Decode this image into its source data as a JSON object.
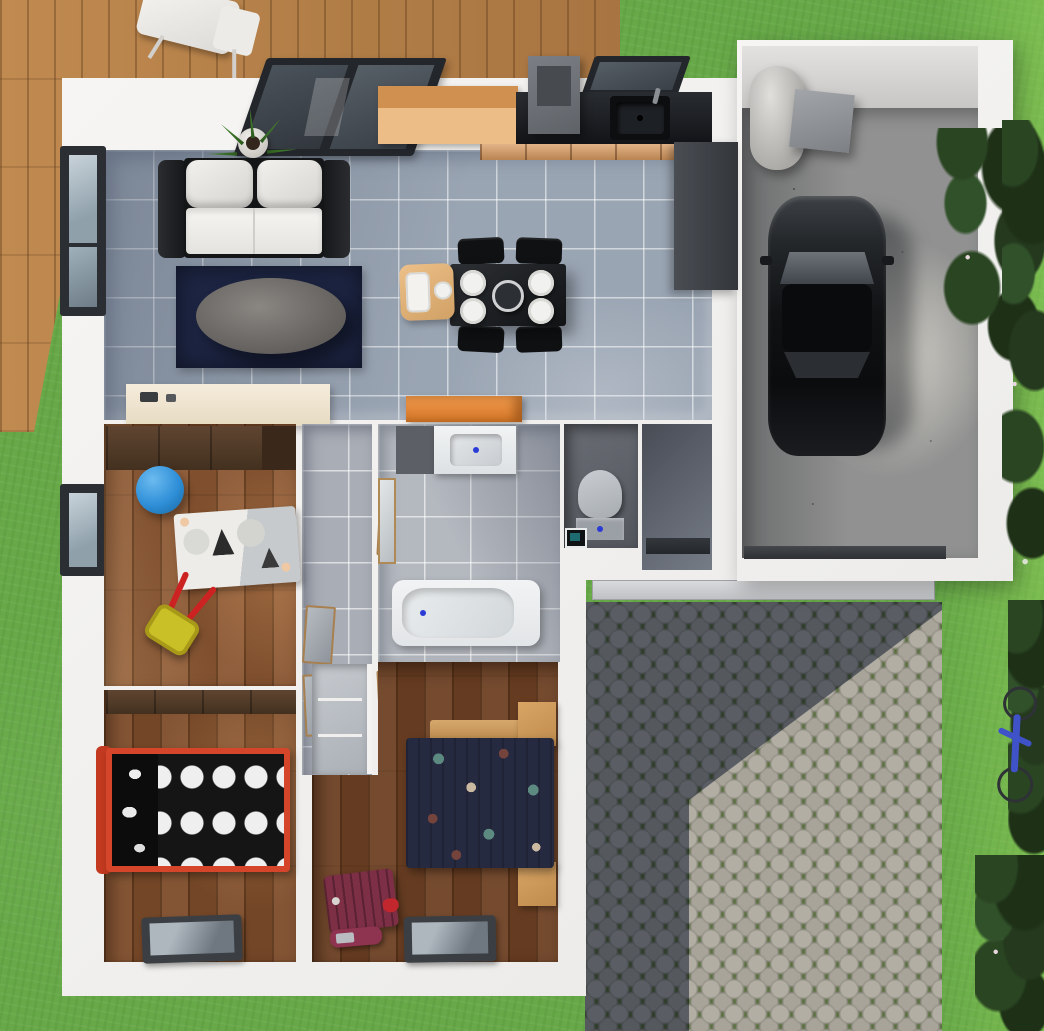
{
  "scene": {
    "title": "Top-down 3D render of a single-storey house floor plan with garage, paved patio, wooden deck and garden",
    "view": "top-down architectural render",
    "visible_text": ""
  },
  "palette": {
    "grass": "#67a948",
    "deck_wood": "#b5824e",
    "wall_white": "#f4f3f1",
    "tile_floor": "#9aa5b3",
    "bathroom_tile": "#b4b8bf",
    "bedroom_wood": "#8a5632",
    "master_wood": "#6e4124",
    "counter_black": "#17191c",
    "cabinet_wood": "#d99a5f",
    "graphite_cabinet": "#3f4347",
    "rug_navy": "#1d2543",
    "sofa_white": "#ecebe8",
    "ball_blue": "#2f8fd8",
    "wheelbarrow_yellow": "#d9ce2d",
    "bed_frame_red": "#d4452a",
    "duvet_black": "#151515",
    "duvet_navy": "#262a40",
    "suitcase_maroon": "#7c2f45",
    "dresser_orange": "#e2833a",
    "garage_concrete": "#909190",
    "cobble_stone": "#aaa69b",
    "cobble_shadow": "#55677e",
    "bush_green": "#2a4522",
    "bicycle_blue": "#4052c8"
  },
  "rooms": {
    "living": {
      "label": "Living room",
      "floor": "grey tile"
    },
    "kitchen": {
      "label": "Kitchen",
      "floor": "grey tile"
    },
    "hallway": {
      "label": "Hallway",
      "floor": "grey tile"
    },
    "kids": {
      "label": "Kids bedroom",
      "floor": "wood"
    },
    "bath": {
      "label": "Bathroom",
      "floor": "light grey tile"
    },
    "wc": {
      "label": "WC",
      "floor": "dark tile"
    },
    "entry": {
      "label": "Entry hall",
      "floor": "dark tile"
    },
    "bedroom": {
      "label": "Bedroom",
      "floor": "wood"
    },
    "master": {
      "label": "Master bedroom",
      "floor": "wood"
    },
    "garage": {
      "label": "Garage",
      "floor": "concrete"
    },
    "patio": {
      "label": "Paved patio",
      "floor": "cobblestones"
    },
    "deck": {
      "label": "Wooden deck",
      "floor": "wood planks"
    },
    "garden": {
      "label": "Garden lawn",
      "floor": "grass"
    }
  },
  "items": {
    "deck_chair": "Deck chair",
    "sofa": "Sofa",
    "coffee_table": "Coffee table",
    "area_rug": "Navy area rug",
    "potted_plant": "Potted plant",
    "sliding_window": "Sliding glass door",
    "kitchen_window": "Kitchen window",
    "side_window": "Side window",
    "sideboard": "Sideboard",
    "dining_table": "Dining table",
    "dining_chair": "Dining chair",
    "high_chair": "High chair",
    "plate": "Plate",
    "serving_bowl": "Serving bowl",
    "kitchen_island": "Kitchen cabinet block",
    "range_hood": "Range hood",
    "kitchen_counter": "Kitchen counter",
    "kitchen_sink": "Kitchen sink",
    "kitchen_drawers": "Kitchen drawers",
    "tall_cabinet": "Tall cabinet / fridge",
    "orange_dresser": "Orange dresser",
    "wardrobe": "Wardrobe",
    "play_ball": "Blue play ball",
    "play_rug": "Zebra play rug",
    "toy_wheelbarrow": "Toy wheelbarrow",
    "vanity_sink": "Vanity sink",
    "mirror": "Mirror",
    "bathtub": "Bathtub",
    "toilet": "Toilet",
    "corner_sink": "Corner sink",
    "front_door": "Front door",
    "interior_door": "Interior door",
    "single_bed": "Single bed with polka-dot duvet",
    "double_bed": "Double bed with patterned duvet",
    "nightstand": "Nightstand",
    "closet": "Closet",
    "suitcase": "Suitcase",
    "travel_bag": "Travel bag",
    "window": "Window",
    "water_heater": "Water heater",
    "utility_box": "Utility box",
    "car": "Car",
    "garage_door": "Garage door",
    "entrance_step": "Entrance step",
    "bicycle": "Bicycle",
    "bushes": "Bushes"
  }
}
